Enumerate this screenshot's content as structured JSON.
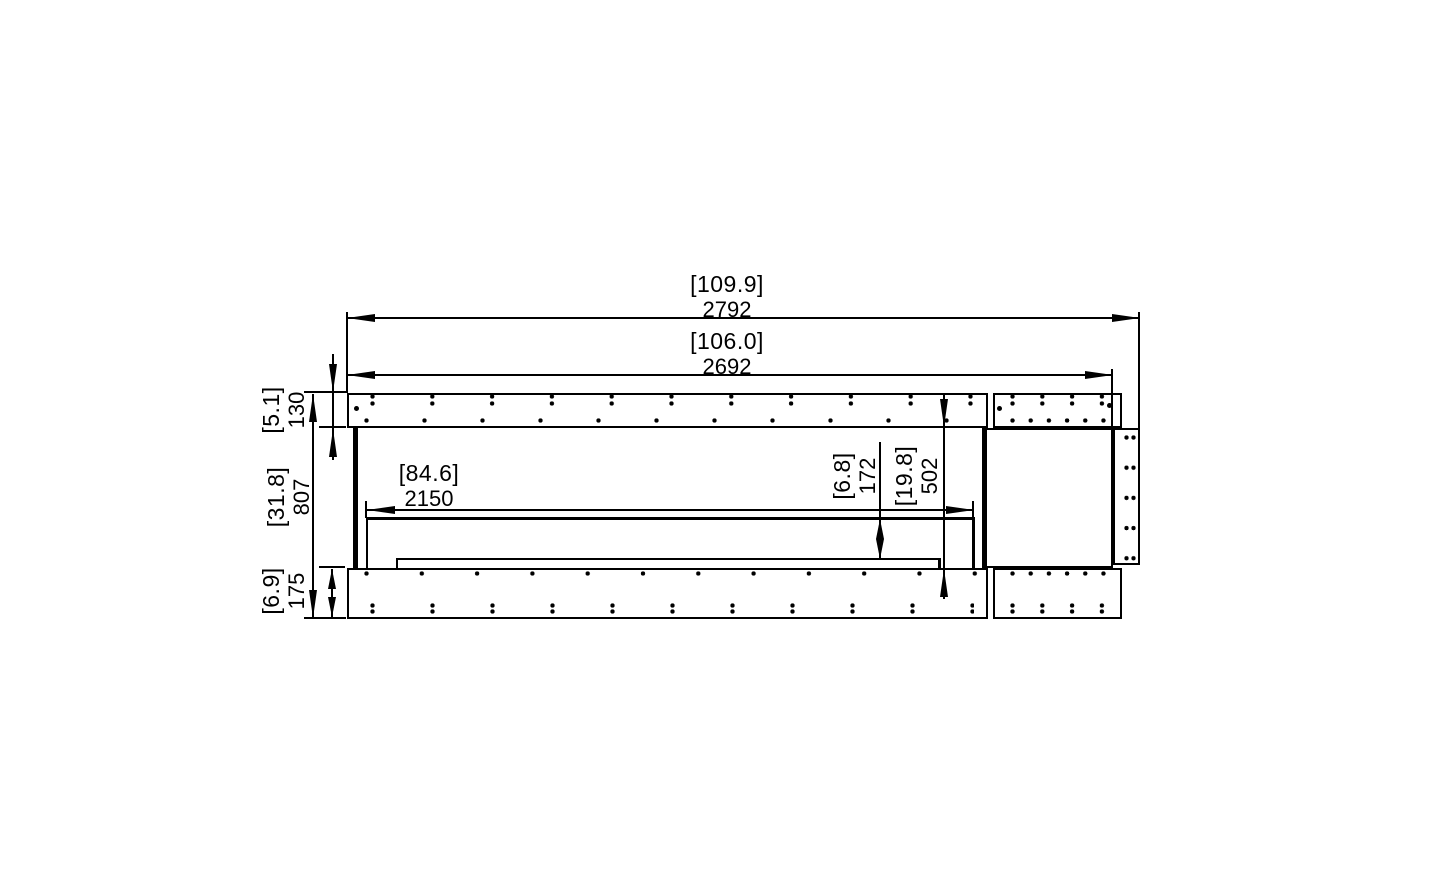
{
  "drawing": {
    "type": "fireplace-firebox-plan-view-technical-drawing",
    "colors": {
      "line": "#000000",
      "background": "#ffffff"
    },
    "dims": {
      "overall_width": {
        "in": "[109.9]",
        "mm": "2792"
      },
      "opening_width": {
        "in": "[106.0]",
        "mm": "2692"
      },
      "burner_width": {
        "in": "[84.6]",
        "mm": "2150"
      },
      "front_depth": {
        "in": "[5.1]",
        "mm": "130"
      },
      "overall_depth": {
        "in": "[31.8]",
        "mm": "807"
      },
      "rear_depth": {
        "in": "[6.9]",
        "mm": "175"
      },
      "burner_depth": {
        "in": "[6.8]",
        "mm": "172"
      },
      "firebox_depth": {
        "in": "[19.8]",
        "mm": "502"
      }
    }
  }
}
